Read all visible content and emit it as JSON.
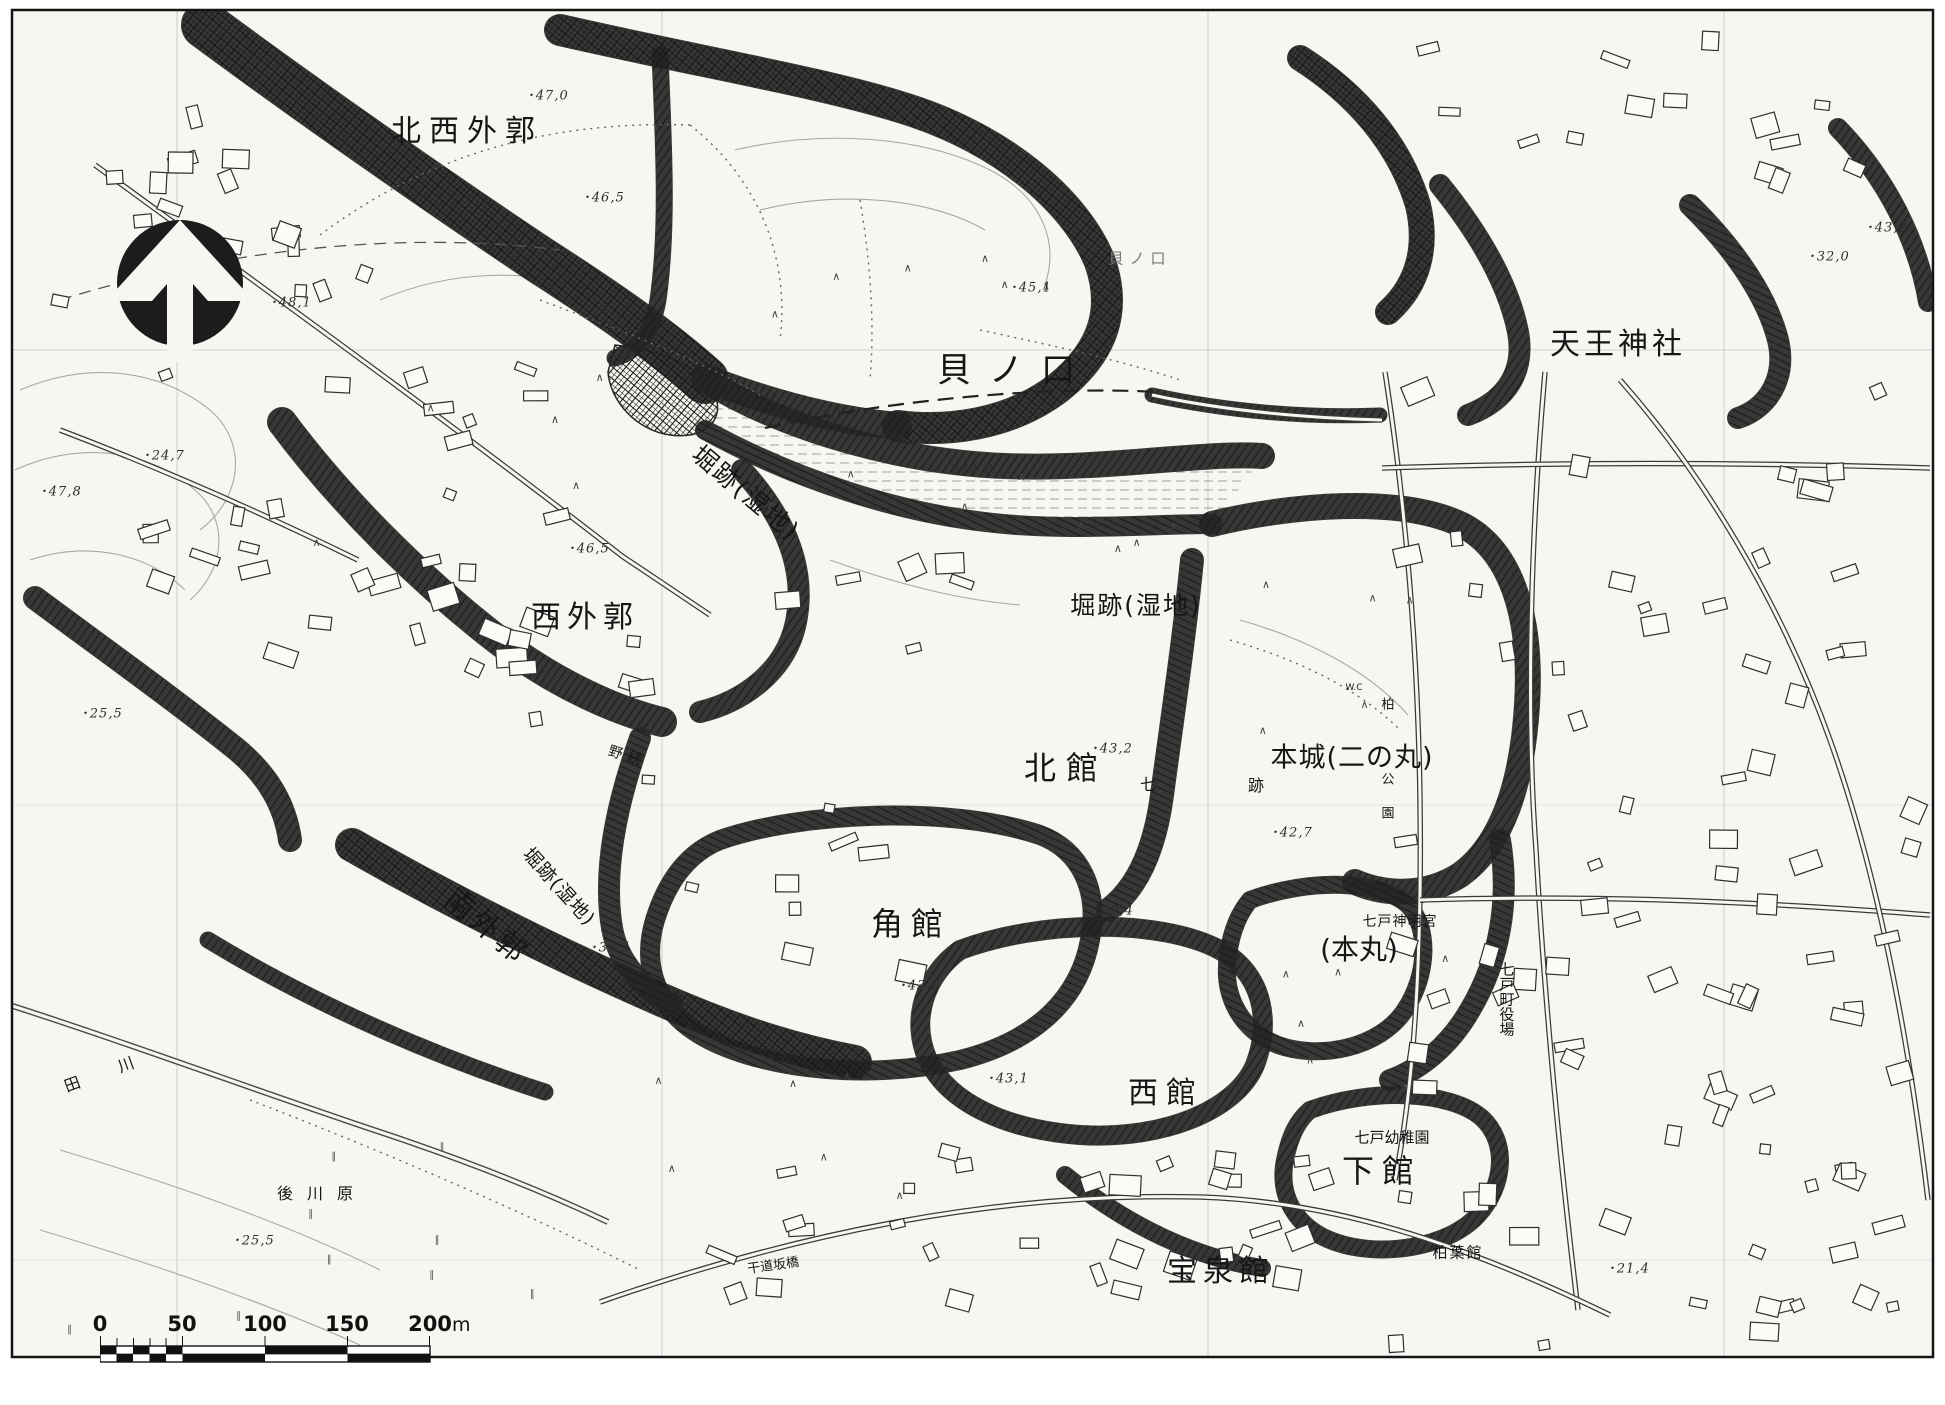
{
  "labels": [
    {
      "text": "北西外郭"
    },
    {
      "text": "貝ノ口"
    },
    {
      "text": "天王神社"
    },
    {
      "text": "堀跡(湿地)"
    },
    {
      "text": "西外郭"
    },
    {
      "text": "堀跡(湿地)"
    },
    {
      "text": "北館"
    },
    {
      "text": "本城(二の丸)"
    },
    {
      "text": "角館"
    },
    {
      "text": "(本丸)"
    },
    {
      "text": "西館"
    },
    {
      "text": "下館"
    },
    {
      "text": "宝泉館"
    },
    {
      "text": "南外郭"
    },
    {
      "text": "堀跡(湿地)"
    },
    {
      "text": "七戸神明宮"
    },
    {
      "text": "七戸町役場"
    },
    {
      "text": "七戸幼稚園"
    },
    {
      "text": "柏葉館"
    },
    {
      "text": "後川原"
    },
    {
      "text": "田 川"
    },
    {
      "text": "野続"
    },
    {
      "text": "干道坂橋"
    },
    {
      "text": "貝ノ口"
    },
    {
      "text": "七"
    },
    {
      "text": "跡"
    },
    {
      "text": "柏"
    },
    {
      "text": "公"
    },
    {
      "text": "園"
    },
    {
      "text": "W.C"
    }
  ],
  "elevations": [
    {
      "value": "48,1"
    },
    {
      "value": "47,0"
    },
    {
      "value": "46,5"
    },
    {
      "value": "45,1"
    },
    {
      "value": "44,8"
    },
    {
      "value": "24,7"
    },
    {
      "value": "47,8"
    },
    {
      "value": "46,5"
    },
    {
      "value": "25,5"
    },
    {
      "value": "43,2"
    },
    {
      "value": "39,4"
    },
    {
      "value": "43,0"
    },
    {
      "value": "42,7"
    },
    {
      "value": "39,1"
    },
    {
      "value": "43,1"
    },
    {
      "value": "25,5"
    },
    {
      "value": "21,4"
    },
    {
      "value": "32,0"
    },
    {
      "value": "43,2"
    }
  ],
  "scale": {
    "ticks": [
      "0",
      "50",
      "100",
      "150",
      "200"
    ],
    "unit": "m"
  }
}
